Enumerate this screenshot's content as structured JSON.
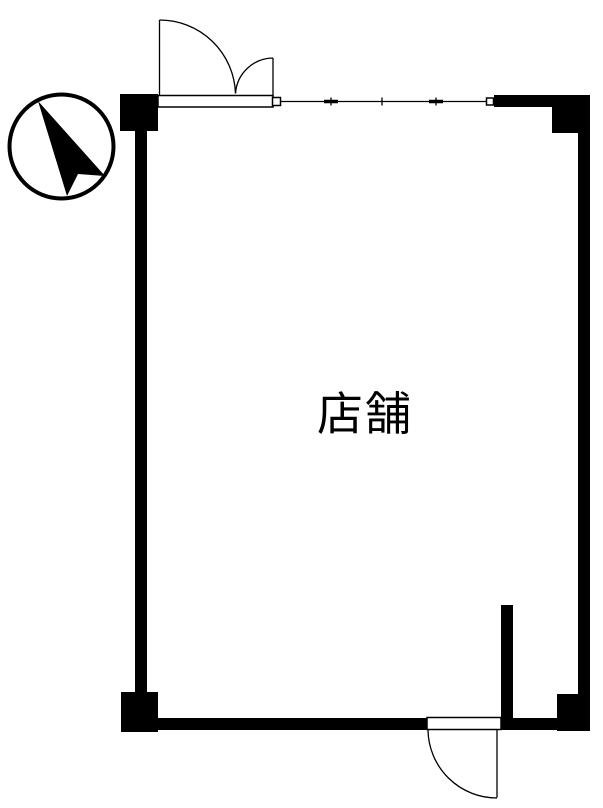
{
  "page": {
    "background_color": "#ffffff",
    "line_color": "#000000"
  },
  "floor_plan": {
    "room_label": "店舗",
    "symbols": {
      "north_arrow": "north-arrow",
      "entrance": "double-swing-door",
      "back_door": "single-swing-door",
      "storefront_window": "fixed-window"
    }
  }
}
